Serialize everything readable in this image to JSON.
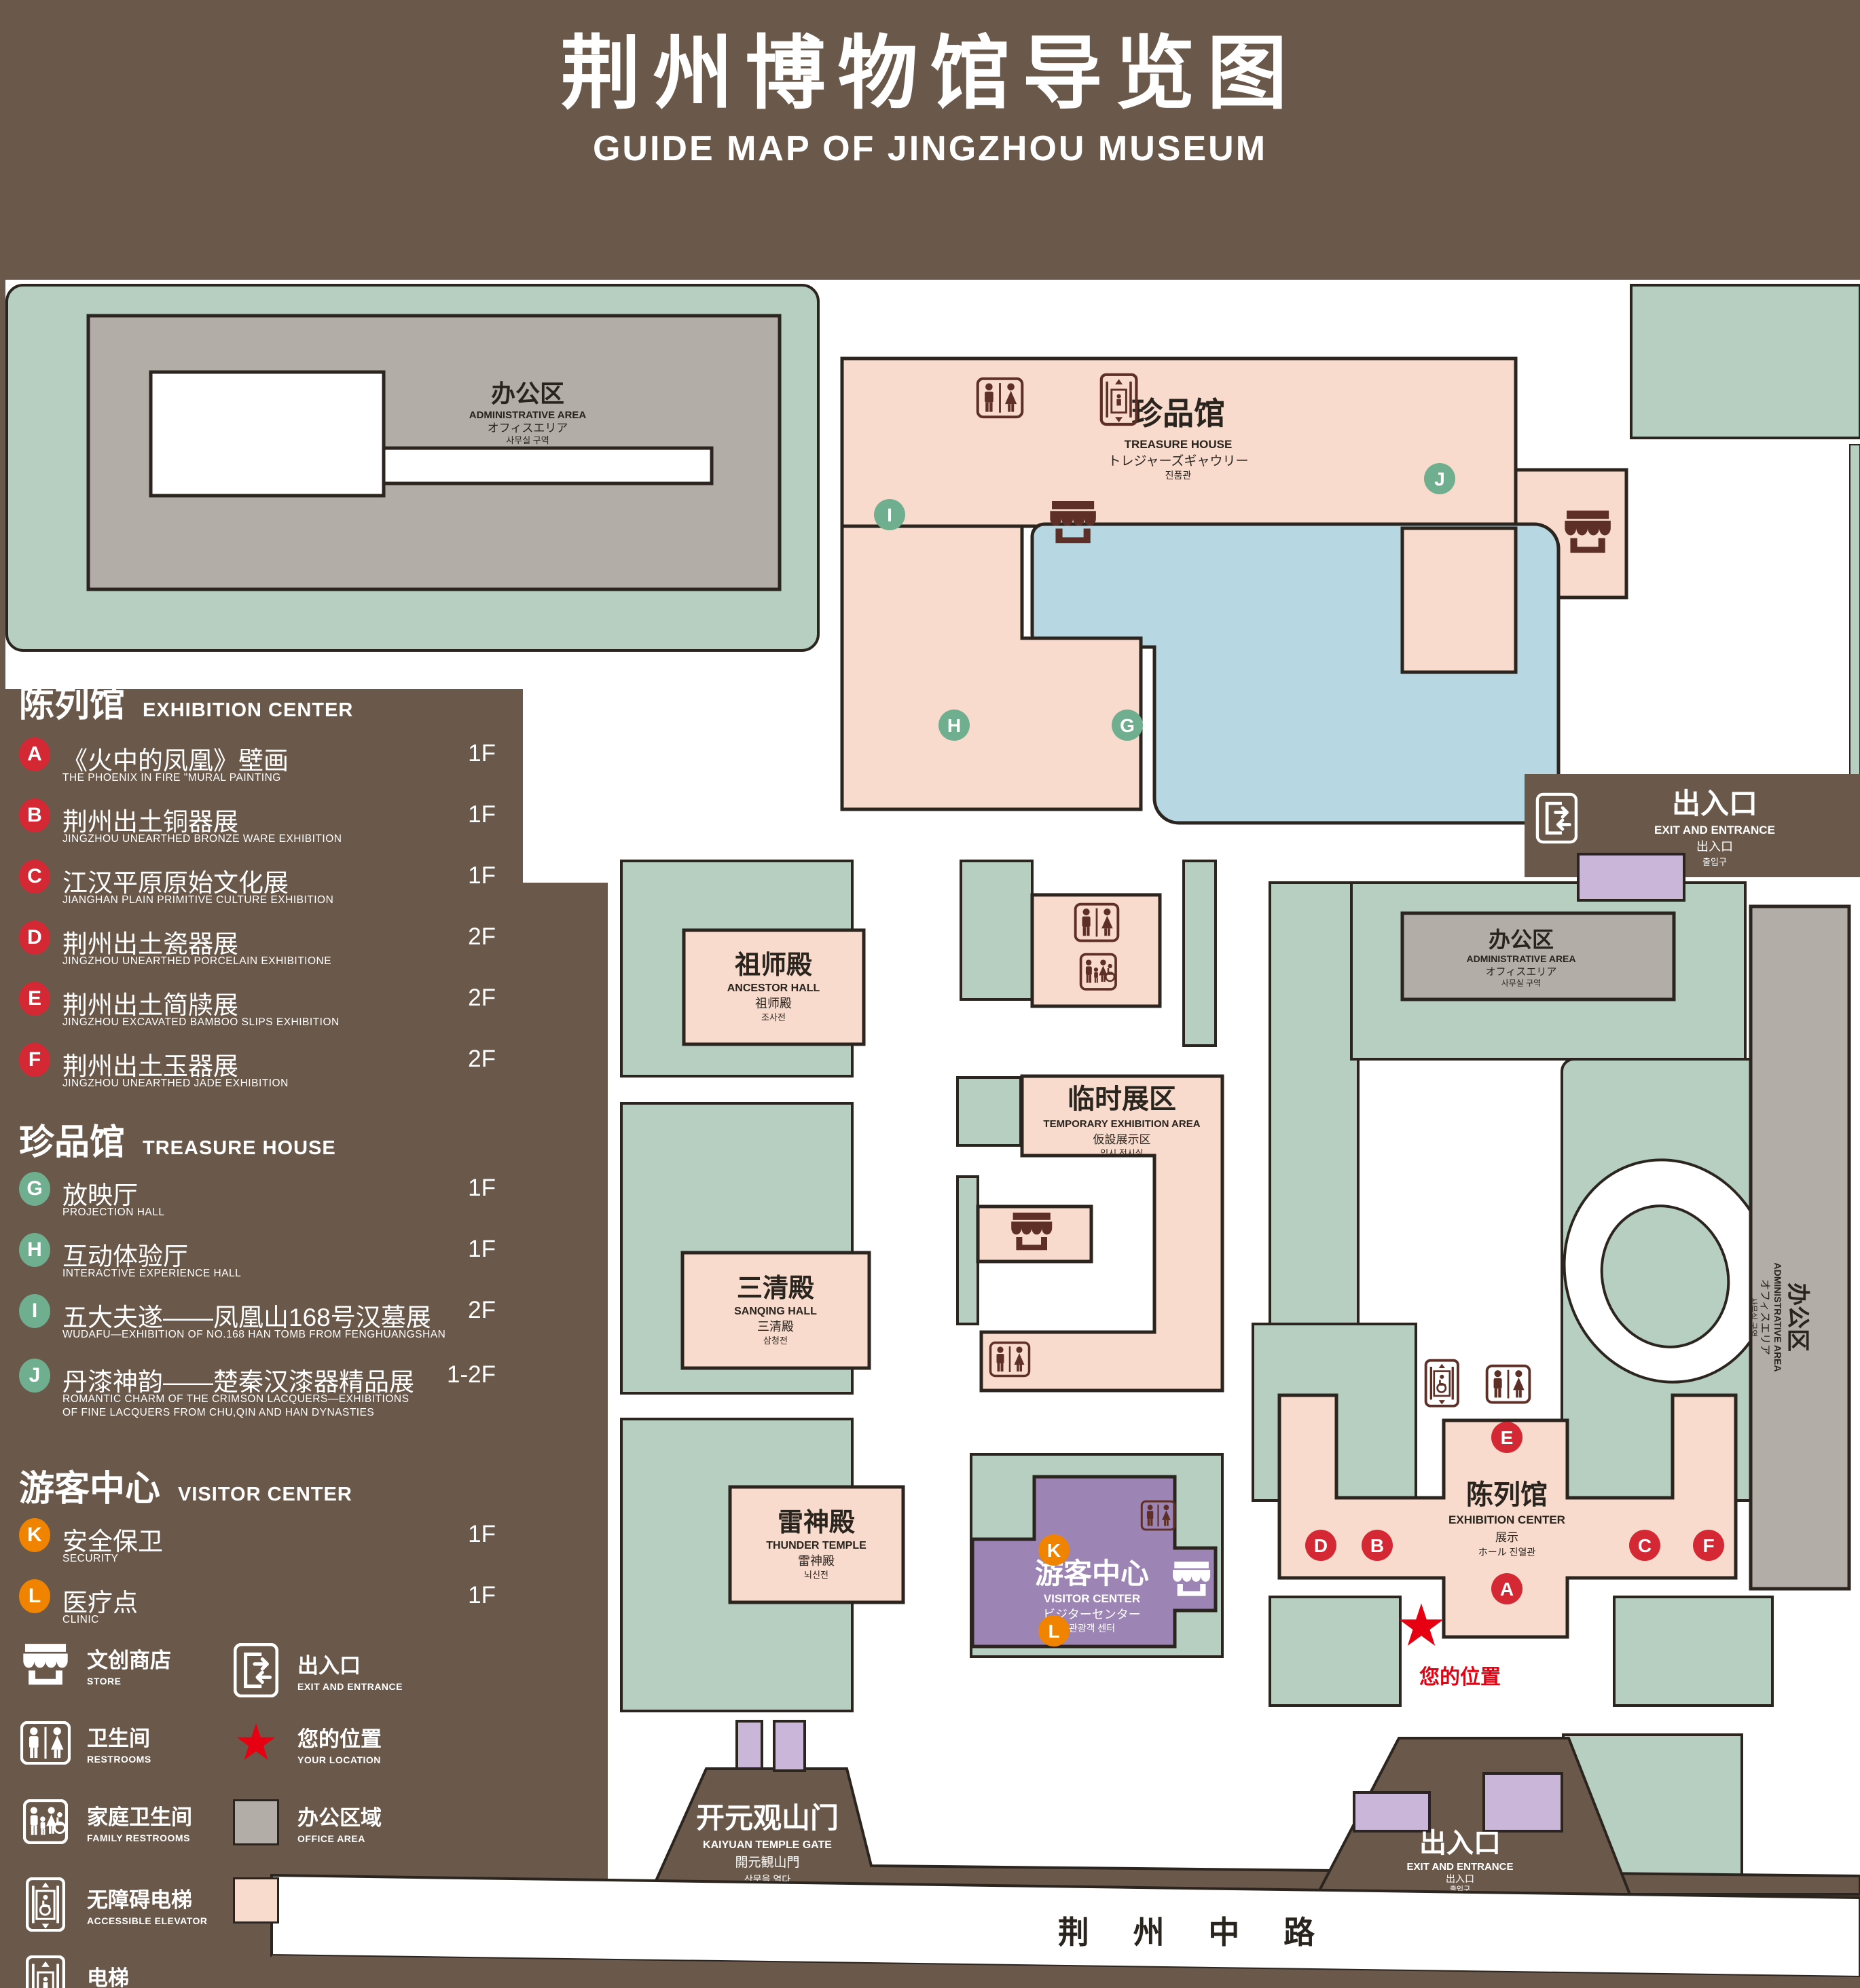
{
  "title": {
    "zh": "荆州博物馆导览图",
    "en": "GUIDE MAP OF JINGZHOU MUSEUM"
  },
  "legend_sections": [
    {
      "zh": "陈列馆",
      "en": "EXHIBITION CENTER",
      "items": [
        {
          "letter": "A",
          "zh": "《火中的凤凰》壁画",
          "en": "THE PHOENIX IN FIRE \"MURAL PAINTING",
          "floor": "1F"
        },
        {
          "letter": "B",
          "zh": "荆州出土铜器展",
          "en": "JINGZHOU UNEARTHED BRONZE WARE EXHIBITION",
          "floor": "1F"
        },
        {
          "letter": "C",
          "zh": "江汉平原原始文化展",
          "en": "JIANGHAN PLAIN PRIMITIVE CULTURE EXHIBITION",
          "floor": "1F"
        },
        {
          "letter": "D",
          "zh": "荆州出土瓷器展",
          "en": "JINGZHOU UNEARTHED PORCELAIN EXHIBITIONE",
          "floor": "2F"
        },
        {
          "letter": "E",
          "zh": "荆州出土简牍展",
          "en": "JINGZHOU EXCAVATED BAMBOO SLIPS EXHIBITION",
          "floor": "2F"
        },
        {
          "letter": "F",
          "zh": "荆州出土玉器展",
          "en": "JINGZHOU UNEARTHED JADE EXHIBITION",
          "floor": "2F"
        }
      ]
    },
    {
      "zh": "珍品馆",
      "en": "TREASURE HOUSE",
      "items": [
        {
          "letter": "G",
          "zh": "放映厅",
          "en": "PROJECTION HALL",
          "floor": "1F"
        },
        {
          "letter": "H",
          "zh": "互动体验厅",
          "en": "INTERACTIVE EXPERIENCE HALL",
          "floor": "1F"
        },
        {
          "letter": "I",
          "zh": "五大夫遂——凤凰山168号汉墓展",
          "en": "WUDAFU—EXHIBITION OF NO.168 HAN TOMB FROM FENGHUANGSHAN",
          "floor": "2F"
        },
        {
          "letter": "J",
          "zh": "丹漆神韵——楚秦汉漆器精品展",
          "en": "ROMANTIC CHARM OF THE CRIMSON LACQUERS—EXHIBITIONS\nOF FINE LACQUERS FROM CHU,QIN AND HAN DYNASTIES",
          "floor": "1-2F"
        }
      ]
    },
    {
      "zh": "游客中心",
      "en": "VISITOR CENTER",
      "items": [
        {
          "letter": "K",
          "zh": "安全保卫",
          "en": "SECURITY",
          "floor": "1F"
        },
        {
          "letter": "L",
          "zh": "医疗点",
          "en": "CLINIC",
          "floor": "1F"
        }
      ]
    }
  ],
  "symbol_legend": {
    "store": {
      "zh": "文创商店",
      "en": "STORE"
    },
    "exit": {
      "zh": "出入口",
      "en": "EXIT AND ENTRANCE"
    },
    "restrooms": {
      "zh": "卫生间",
      "en": "RESTROOMS"
    },
    "your_location": {
      "zh": "您的位置",
      "en": "YOUR LOCATION"
    },
    "family_restrooms": {
      "zh": "家庭卫生间",
      "en": "FAMILY RESTROOMS"
    },
    "office_area": {
      "zh": "办公区域",
      "en": "OFFICE AREA"
    },
    "accessible_elevator": {
      "zh": "无障碍电梯",
      "en": "ACCESSIBLE ELEVATOR"
    },
    "display_area": {
      "zh": "展示区域",
      "en": "DISPLAY AREA"
    },
    "elevator": {
      "zh": "电梯",
      "en": "Elevator"
    }
  },
  "map": {
    "buildings": {
      "admin": {
        "zh": "办公区",
        "en": "ADMINISTRATIVE AREA",
        "ja": "オフィスエリア",
        "ko": "사무실 구역"
      },
      "treasure_house": {
        "zh": "珍品馆",
        "en": "TREASURE HOUSE",
        "ja": "トレジャーズギャウリー",
        "ko": "진품관"
      },
      "ancestor_hall": {
        "zh": "祖师殿",
        "en": "ANCESTOR HALL",
        "ja": "祖师殿",
        "ko": "조사전"
      },
      "temporary_exhibition": {
        "zh": "临时展区",
        "en": "TEMPORARY EXHIBITION AREA",
        "ja": "仮設展示区",
        "ko": "임시 전시실"
      },
      "sanqing_hall": {
        "zh": "三清殿",
        "en": "SANQING HALL",
        "ja": "三清殿",
        "ko": "삼청전"
      },
      "thunder_temple": {
        "zh": "雷神殿",
        "en": "THUNDER TEMPLE",
        "ja": "雷神殿",
        "ko": "뇌신전"
      },
      "visitor_center": {
        "zh": "游客中心",
        "en": "VISITOR CENTER",
        "ja": "ビジターセンター",
        "ko": "관광객 센터"
      },
      "exhibition_center": {
        "zh": "陈列馆",
        "en": "EXHIBITION CENTER",
        "ja": "展示",
        "ko": "ホール 진열관"
      },
      "kaiyuan_gate": {
        "zh": "开元观山门",
        "en": "KAIYUAN TEMPLE GATE",
        "ja": "開元観山門",
        "ko": "산문을 열다"
      },
      "exit_gate": {
        "zh": "出入口",
        "en": "EXIT AND ENTRANCE",
        "ja": "出入口",
        "ko": "출입구"
      },
      "road": {
        "zh": "荆 州 中 路"
      }
    },
    "your_location_label": "您的位置"
  },
  "colors": {
    "background": "#6a594b",
    "green": "#b7cfc1",
    "pink": "#f8dbcc",
    "gray": "#b3ada8",
    "lake": "#b7d7e3",
    "purple": "#9c84b4",
    "light_purple": "#cab6d8",
    "marker_red": "#d42834",
    "marker_green": "#6fae8e",
    "marker_orange": "#f08300",
    "star_red": "#e60012",
    "icon_brown": "#5d2f26"
  }
}
